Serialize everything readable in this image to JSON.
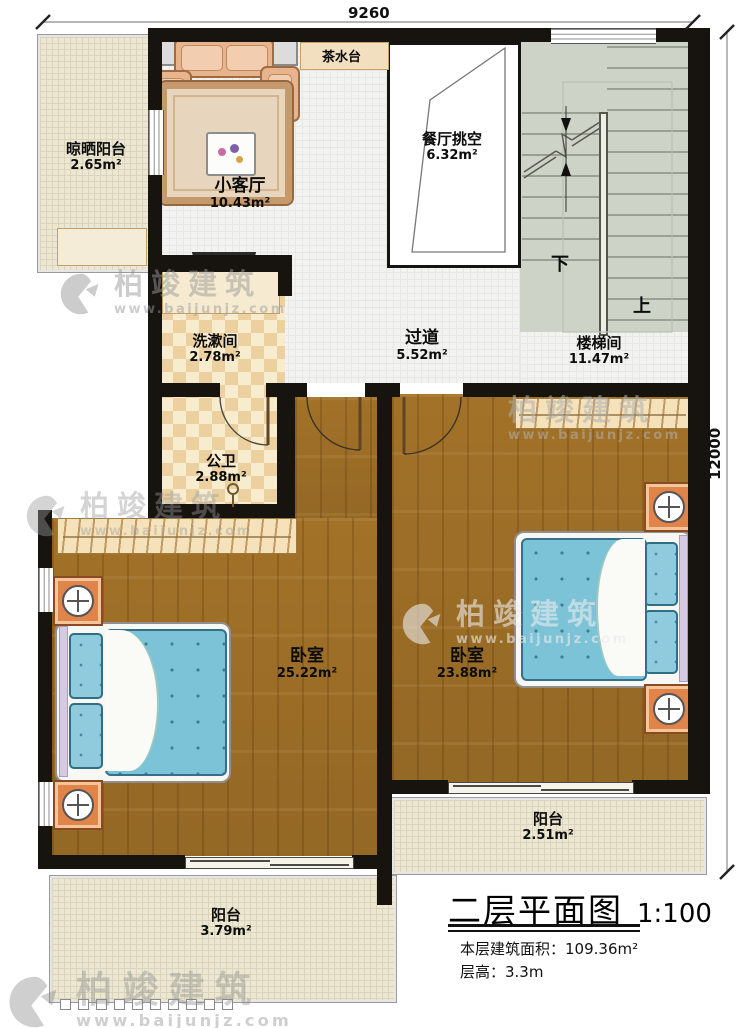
{
  "plan": {
    "dim_width_label": "9260",
    "dim_height_label": "12000",
    "stair_down": "下",
    "stair_up": "上"
  },
  "rooms": {
    "drying_balcony": {
      "name": "晾晒阳台",
      "area": "2.65m²"
    },
    "living": {
      "name": "小客厅",
      "area": "10.43m²"
    },
    "tea_counter": {
      "name": "茶水台"
    },
    "dining_void": {
      "name": "餐厅挑空",
      "area": "6.32m²"
    },
    "washroom": {
      "name": "洗漱间",
      "area": "2.78m²"
    },
    "corridor": {
      "name": "过道",
      "area": "5.52m²"
    },
    "stairwell": {
      "name": "楼梯间",
      "area": "11.47m²"
    },
    "toilet": {
      "name": "公卫",
      "area": "2.88m²"
    },
    "bedroom_left": {
      "name": "卧室",
      "area": "25.22m²"
    },
    "bedroom_right": {
      "name": "卧室",
      "area": "23.88m²"
    },
    "balcony_right": {
      "name": "阳台",
      "area": "2.51m²"
    },
    "balcony_left": {
      "name": "阳台",
      "area": "3.79m²"
    }
  },
  "title_block": {
    "title": "二层平面图",
    "scale": "1:100",
    "floor_area_line": "本层建筑面积：109.36m²",
    "floor_height_line": "层高：3.3m"
  },
  "watermark": {
    "name": "柏竣建筑",
    "url": "www.baijunjz.com"
  },
  "colors": {
    "wall": "#17130f",
    "wood_floor": "#a97a2e",
    "tile": "#f2f2f0",
    "checker_tile": "#ecd0a0",
    "balcony_tile": "#ece7d3",
    "stair": "#cdd3c7",
    "bed_mattress": "#7cc3d8",
    "nightstand": "#e08449"
  }
}
